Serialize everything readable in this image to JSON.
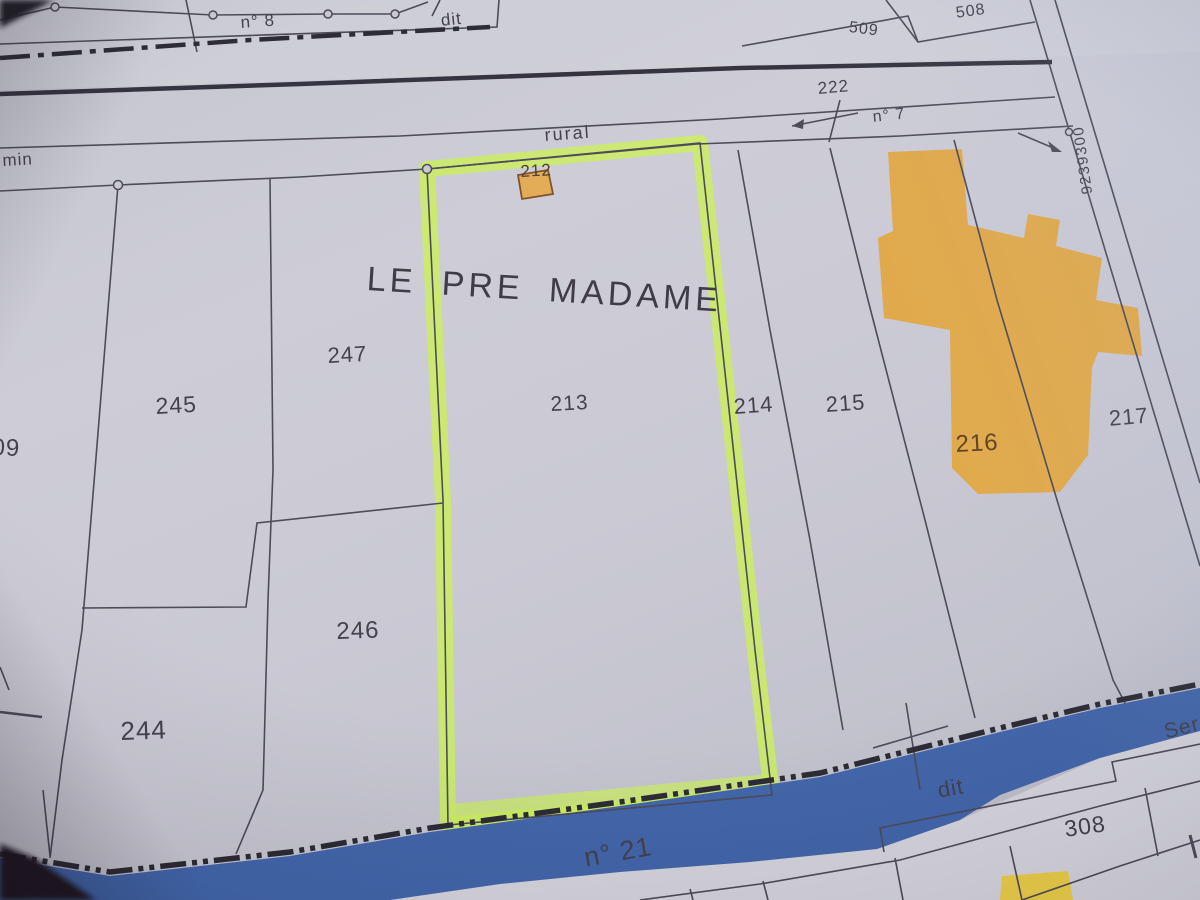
{
  "scene": {
    "type": "photograph of a paper cadastral map sheet",
    "place_name_label": "LE PRE MADAME"
  },
  "labels": {
    "title": "LE PRE MADAME",
    "road_rural": "rural",
    "chemin_fragment": "min",
    "path_n8": "n° 8",
    "dit_top": "dit",
    "dit_bottom": "dit",
    "n7": "n° 7",
    "n21": "n° 21",
    "ser_fragment": "Ser",
    "grid_coordinate": "9239300"
  },
  "parcels": {
    "n212": "212",
    "n213": "213",
    "n214": "214",
    "n215": "215",
    "n216": "216",
    "n217": "217",
    "n222": "222",
    "n244": "244",
    "n245": "245",
    "n246": "246",
    "n247": "247",
    "n308": "308",
    "n508": "508",
    "n509": "509",
    "partial_209": "09"
  },
  "colors": {
    "paper": "#c7c6d1",
    "map_line": "#454250",
    "thick_road_line": "#2b2936",
    "highlighter_green": "#c9ee55",
    "building_orange": "#dfa542",
    "building_small_orange": "#e2a94f",
    "building_yellow": "#e9cb42",
    "stream_blue": "#3a5fa6",
    "boundary_dash": "#23222c",
    "text": "#3b3845"
  }
}
